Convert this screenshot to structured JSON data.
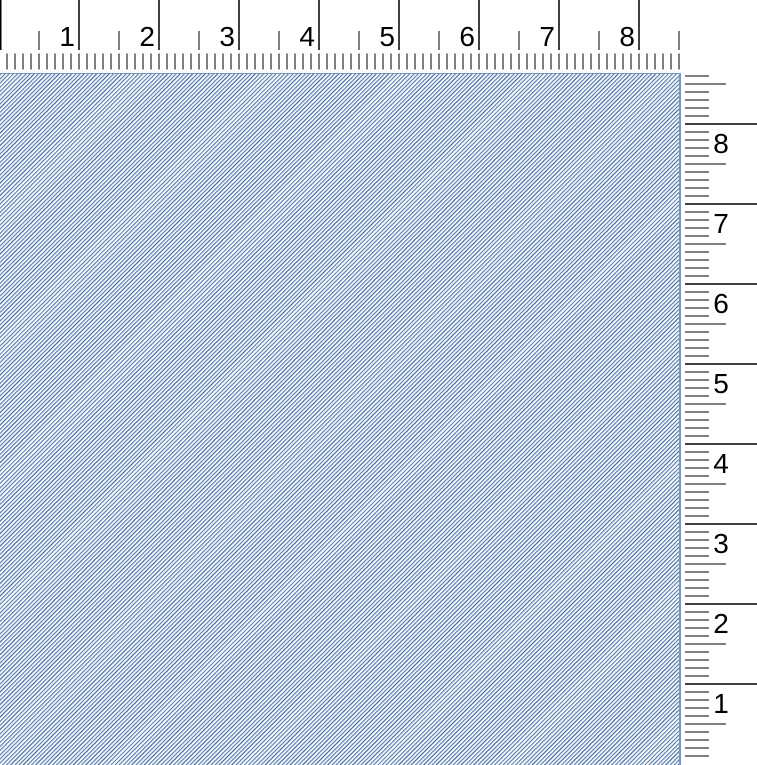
{
  "window": {
    "width_px": 757,
    "height_px": 765
  },
  "horizontal_ruler": {
    "orientation": "horizontal",
    "unit_labels": [
      "1",
      "2",
      "3",
      "4",
      "5",
      "6",
      "7",
      "8"
    ],
    "px_per_unit": 80,
    "minor_ticks_per_unit": 10,
    "length_px": 683,
    "origin_offset_px": -1,
    "tick_color": "#000000",
    "label_color": "#000000",
    "background_color": "#ffffff"
  },
  "vertical_ruler": {
    "orientation": "vertical",
    "numbering_direction": "bottom-to-top",
    "unit_labels_top_to_bottom": [
      "8",
      "7",
      "6",
      "5",
      "4",
      "3",
      "2",
      "1"
    ],
    "px_per_unit": 80,
    "minor_ticks_per_unit": 10,
    "length_px": 693,
    "origin_local_y_px": 692,
    "tick_color": "#000000",
    "label_color": "#000000",
    "background_color": "#ffffff"
  },
  "canvas": {
    "texture": "diagonal-dither-blue",
    "pattern_direction": "bottom-left-to-top-right",
    "pattern_period_px": 4,
    "dark_color": "#4a6fa3",
    "mid_color": "#a9bfd8",
    "light_color": "#f6f9fc",
    "edge_color": "#7a94bc"
  }
}
